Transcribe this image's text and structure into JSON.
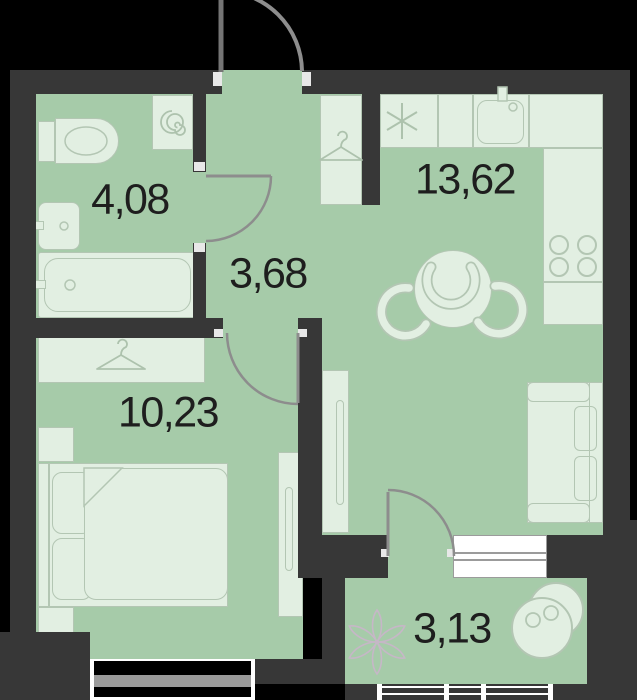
{
  "meta": {
    "type": "apartment-floor-plan",
    "units": "square-meters"
  },
  "colors": {
    "bg": "#000000",
    "wall": "#373737",
    "floor": "#a6cba9",
    "furn": "#e2efe2",
    "furnStroke": "#b3c6b3",
    "iconStroke": "#adc2ad",
    "door": "#8d8d8d",
    "doorLeaf": "#757575",
    "windowFrame": "#ffffff",
    "windowGlass": "#9b9b9b",
    "windowVoid": "#000000",
    "plant": "#c6b7c7",
    "jamb": "#e8e8e8",
    "ink": "#1e1e1e"
  },
  "rooms": [
    {
      "id": "bathroom",
      "area": "4,08"
    },
    {
      "id": "hallway",
      "area": "3,68"
    },
    {
      "id": "kitchen-living",
      "area": "13,62"
    },
    {
      "id": "bedroom",
      "area": "10,23"
    },
    {
      "id": "balcony",
      "area": "3,13"
    }
  ],
  "icons": {
    "washing_machine": "spiral-icon",
    "fridge_spot": "asterisk-icon",
    "wardrobes": "hanger-icon",
    "stove": "four-burner-icon",
    "plant": "flower-icon"
  }
}
